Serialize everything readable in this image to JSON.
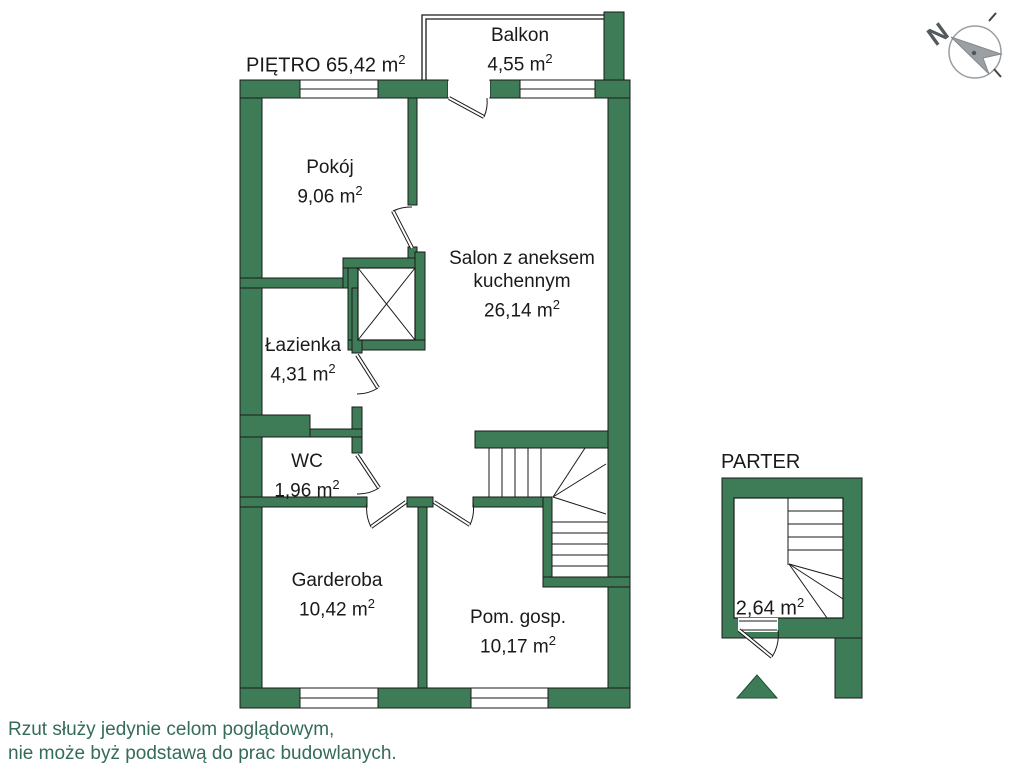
{
  "title": {
    "text": "PIĘTRO 65,42 m",
    "sup": "2"
  },
  "rooms": {
    "balkon": {
      "name": "Balkon",
      "area": "4,55 m",
      "sup": "2"
    },
    "pokoj": {
      "name": "Pokój",
      "area": "9,06 m",
      "sup": "2"
    },
    "salon": {
      "line1": "Salon z aneksem",
      "line2": "kuchennym",
      "area": "26,14 m",
      "sup": "2"
    },
    "lazienka": {
      "name": "Łazienka",
      "area": "4,31 m",
      "sup": "2"
    },
    "wc": {
      "name": "WC",
      "area": "1,96 m",
      "sup": "2"
    },
    "garderoba": {
      "name": "Garderoba",
      "area": "10,42 m",
      "sup": "2"
    },
    "pom_gosp": {
      "name": "Pom. gosp.",
      "area": "10,17 m",
      "sup": "2"
    }
  },
  "parter": {
    "title": "PARTER",
    "area": "2,64 m",
    "sup": "2"
  },
  "compass": {
    "letter": "N"
  },
  "disclaimer": {
    "line1": "Rzut służy jedynie celom poglądowym,",
    "line2": "nie może byż podstawą do prac budowlanych."
  },
  "colors": {
    "wall_green": "#3D7C57",
    "disclaimer_green": "#346B59",
    "outline": "#1a1a1a",
    "compass_gray": "#999EA1"
  }
}
